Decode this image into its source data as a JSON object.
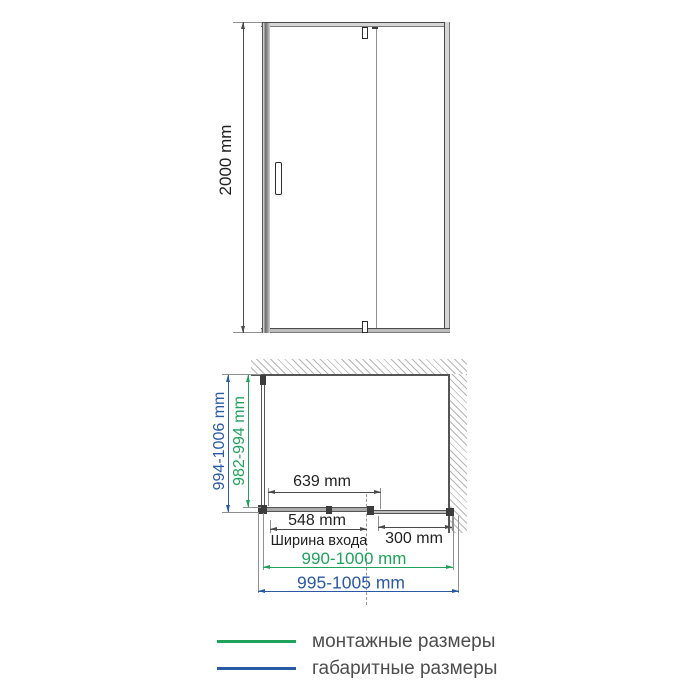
{
  "front_view": {
    "height_dim": "2000 mm"
  },
  "plan_view": {
    "overall_depth_dim": "994-1006 mm",
    "mounting_depth_dim": "982-994 mm",
    "glass_door_dim": "639 mm",
    "entrance_width_dim": "548 mm",
    "entrance_width_caption": "Ширина входа",
    "fixed_panel_dim": "300 mm",
    "mounting_width_dim": "990-1000 mm",
    "overall_width_dim": "995-1005 mm"
  },
  "legend": {
    "items": [
      {
        "label": "монтажные размеры",
        "color": "#1fa35c"
      },
      {
        "label": "габаритные размеры",
        "color": "#2b5aa5"
      }
    ]
  },
  "colors": {
    "mounting_green": "#1fa35c",
    "overall_blue": "#2b5aa5",
    "drawing_line": "#4a4a4a"
  }
}
